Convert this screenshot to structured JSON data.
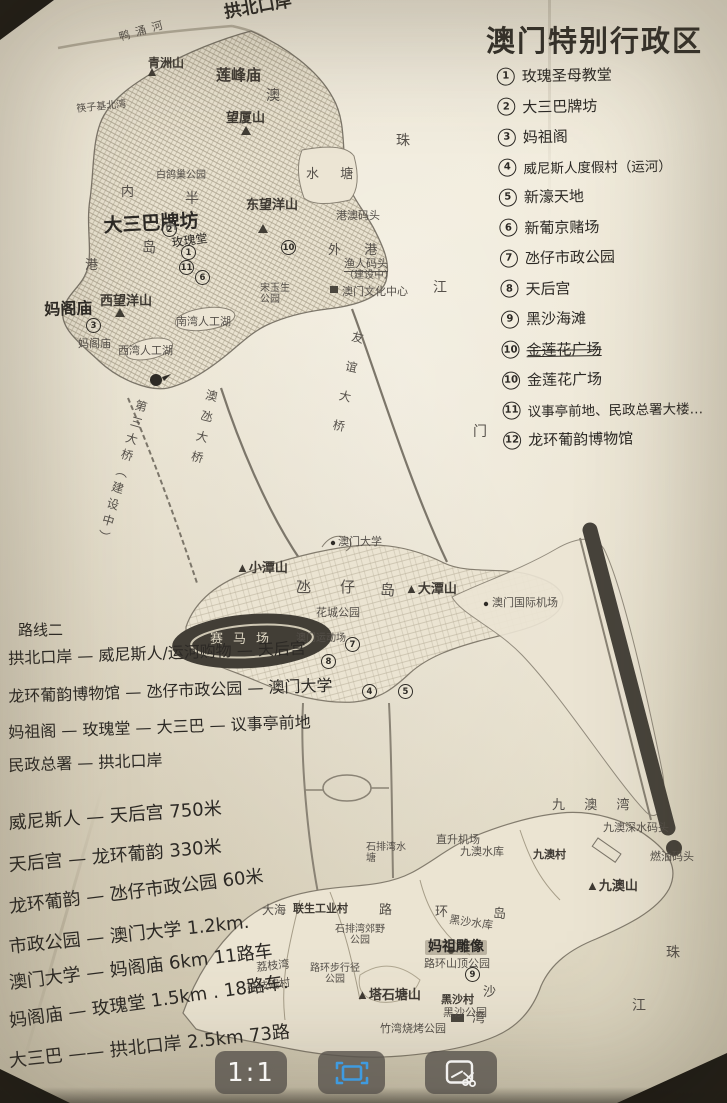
{
  "title": "澳门特别行政区",
  "legend": {
    "items": [
      {
        "num": "1",
        "label": "玫瑰圣母教堂"
      },
      {
        "num": "2",
        "label": "大三巴牌坊"
      },
      {
        "num": "3",
        "label": "妈祖阁"
      },
      {
        "num": "4",
        "label": "威尼斯人度假村（运河）"
      },
      {
        "num": "5",
        "label": "新濠天地"
      },
      {
        "num": "6",
        "label": "新葡京赌场"
      },
      {
        "num": "7",
        "label": "氹仔市政公园"
      },
      {
        "num": "8",
        "label": "天后宫"
      },
      {
        "num": "9",
        "label": "黑沙海滩"
      },
      {
        "num": "10",
        "label": "金莲花广场",
        "struck": true
      },
      {
        "num": "10",
        "label": "金莲花广场"
      },
      {
        "num": "11",
        "label": "议事亭前地、民政总署大楼…"
      },
      {
        "num": "12",
        "label": "龙环葡韵博物馆"
      }
    ]
  },
  "notes": {
    "route_heading": "路线二",
    "route_lines": [
      "拱北口岸 — 威尼斯人/运河购物 — 天后宫",
      "龙环葡韵博物馆 — 氹仔市政公园 — 澳门大学",
      "妈祖阁 — 玫瑰堂 — 大三巴 — 议事亭前地",
      "民政总署 — 拱北口岸"
    ],
    "distance_lines": [
      "威尼斯人 — 天后宫   750米",
      "天后宫 — 龙环葡韵  330米",
      "龙环葡韵 — 氹仔市政公园 60米",
      "市政公园 — 澳门大学 1.2km.",
      "澳门大学 — 妈阁庙 6km  11路车",
      "妈阁庙 — 玫瑰堂 1.5km . 18路车.",
      "大三巴 —— 拱北口岸 2.5km 73路"
    ]
  },
  "map": {
    "labels": {
      "gongbei": "拱北口岸",
      "yachonghe": "鸭涌河",
      "qingzhoushan": "青洲山",
      "lianfengmiao": "莲峰庙",
      "ao": "澳",
      "wangxiashan": "望厦山",
      "kuaiziji": "筷子基北湾",
      "shuitang": "水 塘",
      "nei": "内",
      "ban": "半",
      "baigechao": "白鸽巢公园",
      "dongwangyang": "东望洋山",
      "dasanba": "大三巴牌坊",
      "meiguitang": "玫瑰堂",
      "dao": "岛",
      "gang": "港",
      "gangao_pier": "港澳码头",
      "waigang": "外  港",
      "yuren_pier": "渔人码头",
      "yuren_pier2": "（建设中）",
      "culture_center": "澳门文化中心",
      "songyusheng": "宋玉生公园",
      "xiwangyang": "西望洋山",
      "mage_hand": "妈阁庙",
      "mage_print": "妈阁庙",
      "nanwan_lake": "南湾人工湖",
      "xiwan_lake": "西湾人工湖",
      "bridge3": "第三大桥（建设中）",
      "aodang_bridge": "澳氹大桥",
      "youyi_bridge": "友谊大桥",
      "zhu1": "珠",
      "jiang1": "江",
      "men": "门",
      "um": "澳门大学",
      "xiaotanshan": "▲小潭山",
      "dang": "氹",
      "zai": "仔",
      "dao2": "岛",
      "datanshan": "▲大潭山",
      "huacheng": "花城公园",
      "saimachang": "赛马场",
      "stadium": "澳门运动场",
      "airport": "澳门国际机场",
      "jiuaowan": "九 澳 湾",
      "shenshui_pier": "九澳深水码头",
      "heliport": "直升机场",
      "jiuao_reservoir": "九澳水库",
      "jiuaocun": "九澳村",
      "ranyou_pier": "燃油码头",
      "jiuaoshan": "▲九澳山",
      "shipaiwan_res": "石排湾水塘",
      "dahai": "大海",
      "liansheng": "联生工业村",
      "lu": "路",
      "huan": "环",
      "dao3": "岛",
      "heisha_res": "黑沙水库",
      "shipaiwan_park": "石排湾郊野公园",
      "mazu_statue": "妈祖雕像",
      "luhuan_top": "路环山顶公园",
      "lizhiwan": "荔枝湾",
      "luhuan_walk": "路环步行径公园",
      "lizhiwan_cun": "荔枝碗村",
      "tashitang": "▲塔石塘山",
      "heishacun": "黑沙村",
      "heisha_park": "黑沙公园",
      "zhuwan_bbq": "竹湾烧烤公园",
      "sha": "沙",
      "wan": "湾",
      "zhu2": "珠",
      "jiang2": "江"
    },
    "markers": {
      "m1": "1",
      "m2": "2",
      "m3": "3",
      "m4": "4",
      "m5": "5",
      "m6": "6",
      "m7": "7",
      "m8": "8",
      "m9": "9",
      "m10": "10",
      "m11": "11"
    }
  },
  "toolbar": {
    "actual_size_label": "1:1",
    "fit_icon": "fit-to-screen-icon",
    "crop_icon": "crop-annotate-icon"
  }
}
